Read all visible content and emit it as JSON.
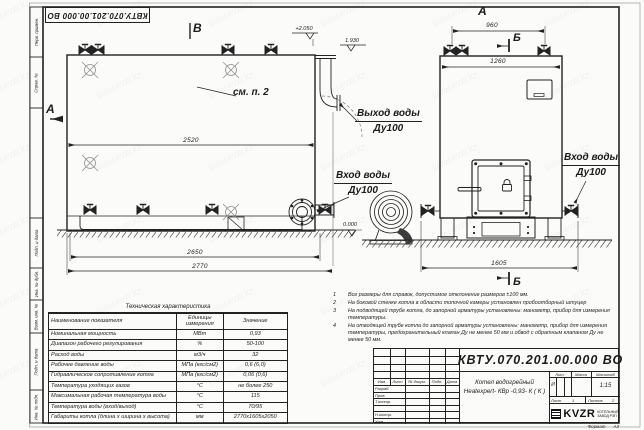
{
  "watermark": "kotel-kvzr.kz",
  "stamp_top": "КВТУ.070.201.00.000  ВО",
  "frame_left": {
    "cells": [
      "Перв. примен.",
      "Справ. №",
      "Подп. и дата",
      "Инв. № дубл.",
      "Взам. инв. №",
      "Подп. и дата",
      "Инв. № подл."
    ]
  },
  "views": {
    "view_b": "В",
    "view_a_top": "А",
    "section_a_left": "А",
    "section_b_top": "Б",
    "section_b_bottom": "Б",
    "see_note": "см. п. 2"
  },
  "elevations": {
    "top": "+2.050",
    "outlet": "1.930",
    "zero": "0.000"
  },
  "dimensions": {
    "side_inner": "2520",
    "base_length": "2650",
    "total_length": "2770",
    "front_top": "960",
    "front_width": "1260",
    "front_total": "1605"
  },
  "ports": {
    "outlet_l1": "Выход воды",
    "outlet_l2": "Ду100",
    "inlet_left_l1": "Вход воды",
    "inlet_left_l2": "Ду100",
    "inlet_right_l1": "Вход воды",
    "inlet_right_l2": "Ду100"
  },
  "tech_table": {
    "title": "Техническая характеристика",
    "headers": {
      "name": "Наименование показателя",
      "unit": "Единицы измерения",
      "value": "Значение"
    },
    "rows": [
      {
        "name": "Номинальная мощность",
        "unit": "МВт",
        "value": "0,93"
      },
      {
        "name": "Диапазон рабочего регулирования",
        "unit": "%",
        "value": "50-100"
      },
      {
        "name": "Расход воды",
        "unit": "м3/ч",
        "value": "32"
      },
      {
        "name": "Рабочее давление воды",
        "unit": "МПа (кгс/см2)",
        "value": "0,6 (6,0)"
      },
      {
        "name": "Гидравлическое сопротивление котла",
        "unit": "МПа (кгс/см2)",
        "value": "0,06 (0,6)"
      },
      {
        "name": "Температура уходящих газов",
        "unit": "°С",
        "value": "не более 250"
      },
      {
        "name": "Максимальная рабочая температура воды",
        "unit": "°С",
        "value": "115"
      },
      {
        "name": "Температура воды (вход/выход)",
        "unit": "°С",
        "value": "70/95"
      },
      {
        "name": "Габариты котла (длина х ширина х высота)",
        "unit": "мм",
        "value": "2770х1605х2050"
      }
    ]
  },
  "notes": {
    "items": [
      {
        "num": "1",
        "text": "Все размеры для справок, допустимое отклонение размеров ±100 мм."
      },
      {
        "num": "2",
        "text": "На боковой стенке котла в области топочной камеры установлен пробоотборный штуцер"
      },
      {
        "num": "3",
        "text": "На  подводящей трубе котла, до запорной арматуры установлены: манометр, прибор для измерения температуры."
      },
      {
        "num": "4",
        "text": "На отводящей трубе котла до запорной арматуры установлены: манометр, прибор для измерения температуры, предохранительный клапан  Ду не менее  50 мм и обвод с обратным клапаном  Ду не менее  50 мм."
      }
    ]
  },
  "title_block": {
    "doc_number": "КВТУ.070.201.00.000  ВО",
    "product_line1": "Котел водогрейный",
    "product_line2": "Heatexpert- КВр -0,93- К ( К )",
    "rev_headers": [
      "Изм.",
      "Лист",
      "№ докум.",
      "Подп.",
      "Дата"
    ],
    "roles": [
      "Разраб.",
      "Пров.",
      "Т.контр.",
      "Н.контр.",
      "Утв."
    ],
    "lit_header": "Лит.",
    "mass_header": "Масса",
    "scale_header": "Масштаб",
    "lit_value": "И",
    "scale_value": "1:15",
    "sheet_label": "Лист",
    "sheet_value": "1",
    "sheets_label": "Листов",
    "sheets_value": "2",
    "logo_word": "KVZR",
    "company_l1": "КОТЕЛЬНЫЙ",
    "company_l2": "ЗАВОД РЭП",
    "format_label": "Формат",
    "format_value": "А3"
  }
}
